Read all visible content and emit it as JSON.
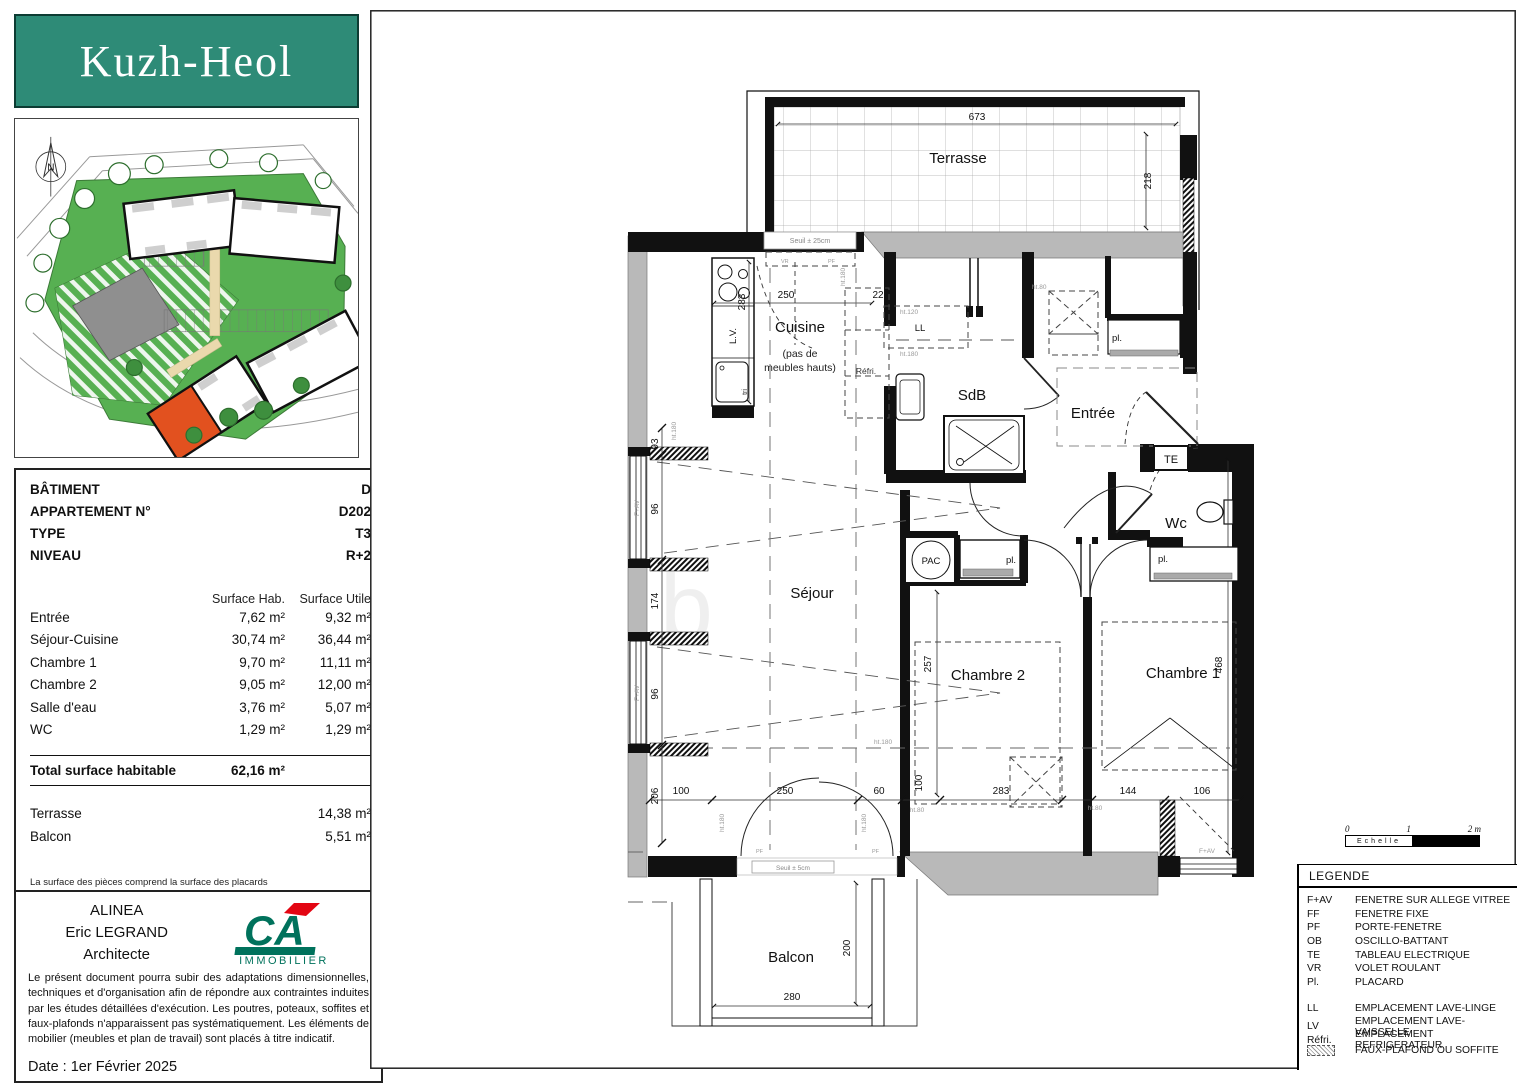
{
  "logo": {
    "title": "Kuzh-Heol"
  },
  "site_plan": {
    "compass": "N"
  },
  "info": {
    "fields": [
      {
        "label": "BÂTIMENT",
        "value": "D"
      },
      {
        "label": "APPARTEMENT N°",
        "value": "D202"
      },
      {
        "label": "TYPE",
        "value": "T3"
      },
      {
        "label": "NIVEAU",
        "value": "R+2"
      }
    ],
    "table": {
      "col_hab": "Surface Hab.",
      "col_utile": "Surface Utile",
      "rows": [
        {
          "label": "Entrée",
          "hab": "7,62 m²",
          "utile": "9,32 m²"
        },
        {
          "label": "Séjour-Cuisine",
          "hab": "30,74 m²",
          "utile": "36,44 m²"
        },
        {
          "label": "Chambre 1",
          "hab": "9,70 m²",
          "utile": "11,11 m²"
        },
        {
          "label": "Chambre 2",
          "hab": "9,05 m²",
          "utile": "12,00 m²"
        },
        {
          "label": "Salle d'eau",
          "hab": "3,76 m²",
          "utile": "5,07 m²"
        },
        {
          "label": "WC",
          "hab": "1,29 m²",
          "utile": "1,29 m²"
        }
      ]
    },
    "total": {
      "label": "Total surface habitable",
      "value": "62,16 m²"
    },
    "extras": [
      {
        "label": "Terrasse",
        "value": "14,38 m²"
      },
      {
        "label": "Balcon",
        "value": "5,51 m²"
      }
    ],
    "note": "La surface des pièces comprend la surface des placards"
  },
  "footer": {
    "firm": "ALINEA",
    "architect": "Eric LEGRAND",
    "role": "Architecte",
    "brand": "CA",
    "brand_sub": "IMMOBILIER",
    "disclaimer": "Le présent document pourra subir des adaptations dimensionnelles, techniques et d'organisation afin de répondre aux contraintes induites par les études détaillées d'exécution. Les poutres, poteaux, soffites et faux-plafonds n'apparaissent pas systématiquement. Les éléments de mobilier (meubles et plan de travail) sont placés à titre indicatif.",
    "date": "Date : 1er Février 2025"
  },
  "plan": {
    "rooms": {
      "terrasse": "Terrasse",
      "cuisine": "Cuisine",
      "cuisine_sub1": "(pas de",
      "cuisine_sub2": "meubles hauts)",
      "sdb": "SdB",
      "entree": "Entrée",
      "wc": "Wc",
      "sejour": "Séjour",
      "chambre1": "Chambre 1",
      "chambre2": "Chambre 2",
      "balcon": "Balcon"
    },
    "equip": {
      "pac": "PAC",
      "te": "TE",
      "ll": "LL",
      "lv": "L.V.",
      "tri": "tri",
      "refri": "Réfri.",
      "pl": "pl."
    },
    "dims": {
      "d673": "673",
      "d218": "218",
      "d250": "250",
      "d22": "22",
      "d283": "283",
      "d93": "93",
      "d96": "96",
      "d174": "174",
      "d206": "206",
      "d100": "100",
      "d60": "60",
      "d144": "144",
      "d106": "106",
      "d257": "257",
      "d468": "468",
      "d200": "200",
      "d280": "280"
    },
    "small": {
      "ht180": "ht.180",
      "ht80": "ht.80",
      "ht120": "ht.120",
      "fav": "F+AV",
      "pf": "PF",
      "vr": "VR",
      "seuil25": "Seuil ± 25cm",
      "seuil5": "Seuil ± 5cm"
    }
  },
  "scale": {
    "t0": "0",
    "t1": "1",
    "t2": "2 m",
    "label": "Echelle"
  },
  "legend": {
    "title": "LEGENDE",
    "items": [
      {
        "code": "F+AV",
        "label": "FENETRE SUR ALLEGE VITREE"
      },
      {
        "code": "FF",
        "label": "FENETRE FIXE"
      },
      {
        "code": "PF",
        "label": "PORTE-FENETRE"
      },
      {
        "code": "OB",
        "label": "OSCILLO-BATTANT"
      },
      {
        "code": "TE",
        "label": "TABLEAU ELECTRIQUE"
      },
      {
        "code": "VR",
        "label": "VOLET ROULANT"
      },
      {
        "code": "Pl.",
        "label": "PLACARD"
      }
    ],
    "items2": [
      {
        "code": "LL",
        "label": "EMPLACEMENT LAVE-LINGE"
      },
      {
        "code": "LV",
        "label": "EMPLACEMENT LAVE-VAISSELLE"
      },
      {
        "code": "Réfri.",
        "label": "EMPLACEMENT REFRIGERATEUR"
      }
    ],
    "hatch_label": "FAUX-PLAFOND OU SOFFITE"
  }
}
